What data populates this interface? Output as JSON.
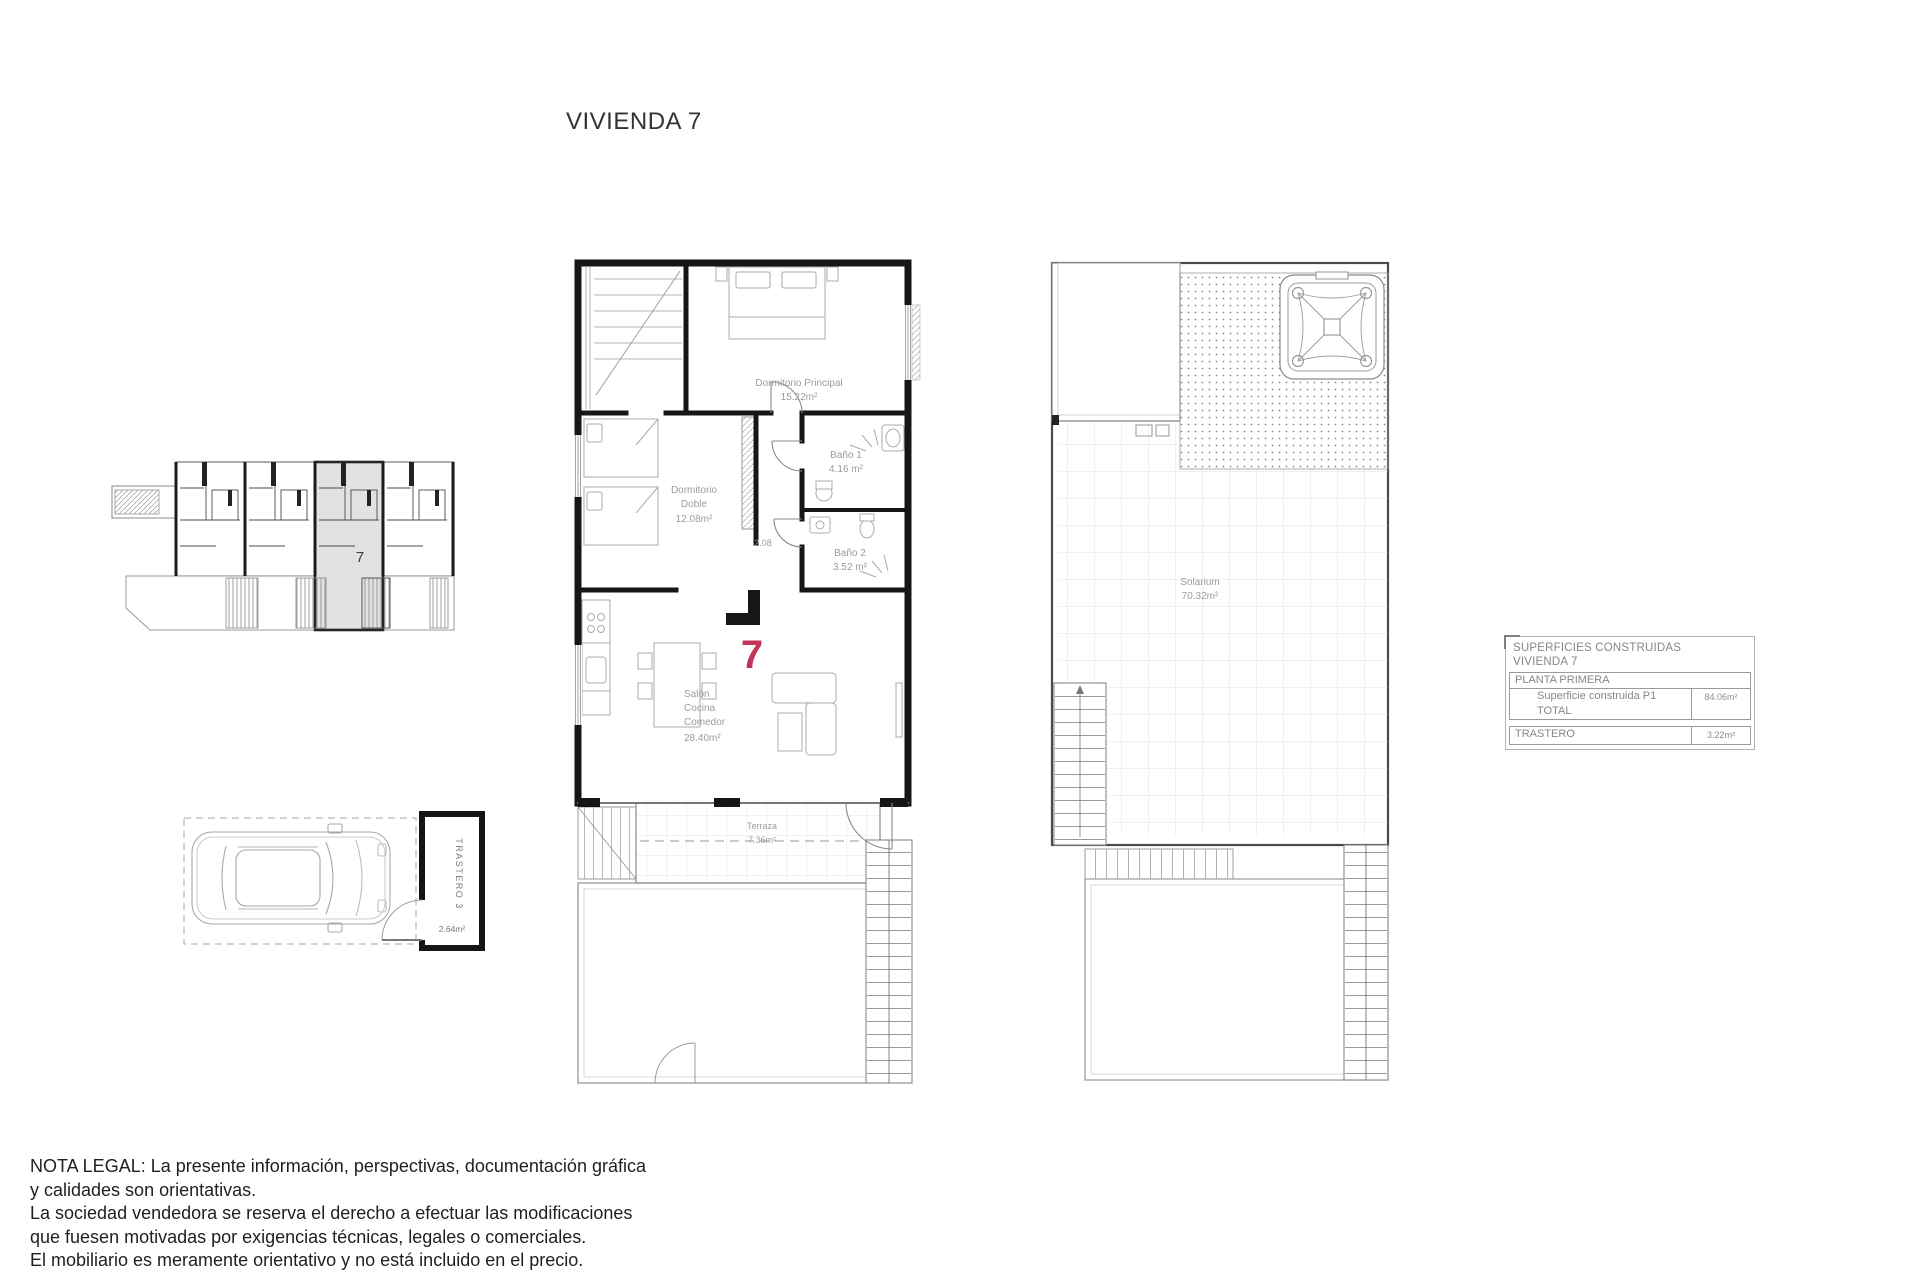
{
  "title": "VIVIENDA 7",
  "accent_color": "#bf3459",
  "site_plan": {
    "unit_label": "7"
  },
  "storage": {
    "label": "TRASTERO 3",
    "area": "2.64m²"
  },
  "main_plan": {
    "unit_number": "7",
    "dimension": "2.08",
    "rooms": {
      "principal": {
        "lines": [
          "Dormitorio Principal",
          "15.22m²"
        ]
      },
      "bano1": {
        "lines": [
          "Baño 1",
          "4.16 m²"
        ]
      },
      "doble": {
        "lines": [
          "Dormitorio",
          "Doble",
          "12.08m²"
        ]
      },
      "bano2": {
        "lines": [
          "Baño 2",
          "3.52 m²"
        ]
      },
      "salon": {
        "lines": [
          "Salón",
          "Cocina",
          "Comedor",
          "28.40m²"
        ]
      },
      "terraza": {
        "lines": [
          "Terraza",
          "7.36m²"
        ]
      }
    }
  },
  "solarium_plan": {
    "room": {
      "lines": [
        "Solarium",
        "70.32m²"
      ]
    }
  },
  "summary_table": {
    "header_lines": [
      "SUPERFICIES CONSTRUIDAS",
      "VIVIENDA 7"
    ],
    "section_row": "PLANTA PRIMERA",
    "rows": [
      {
        "label": "Superficie construida P1 TOTAL",
        "value": "84.06m²"
      },
      {
        "label": "TRASTERO",
        "value": "3.22m²"
      }
    ]
  },
  "legal_note": {
    "lines": [
      "NOTA LEGAL: La presente información, perspectivas, documentación gráfica",
      "y calidades son orientativas.",
      "La sociedad vendedora se reserva el derecho a efectuar las modificaciones",
      "que fuesen motivadas por exigencias técnicas, legales o comerciales.",
      "El mobiliario es meramente orientativo y no está incluido en el precio."
    ]
  }
}
